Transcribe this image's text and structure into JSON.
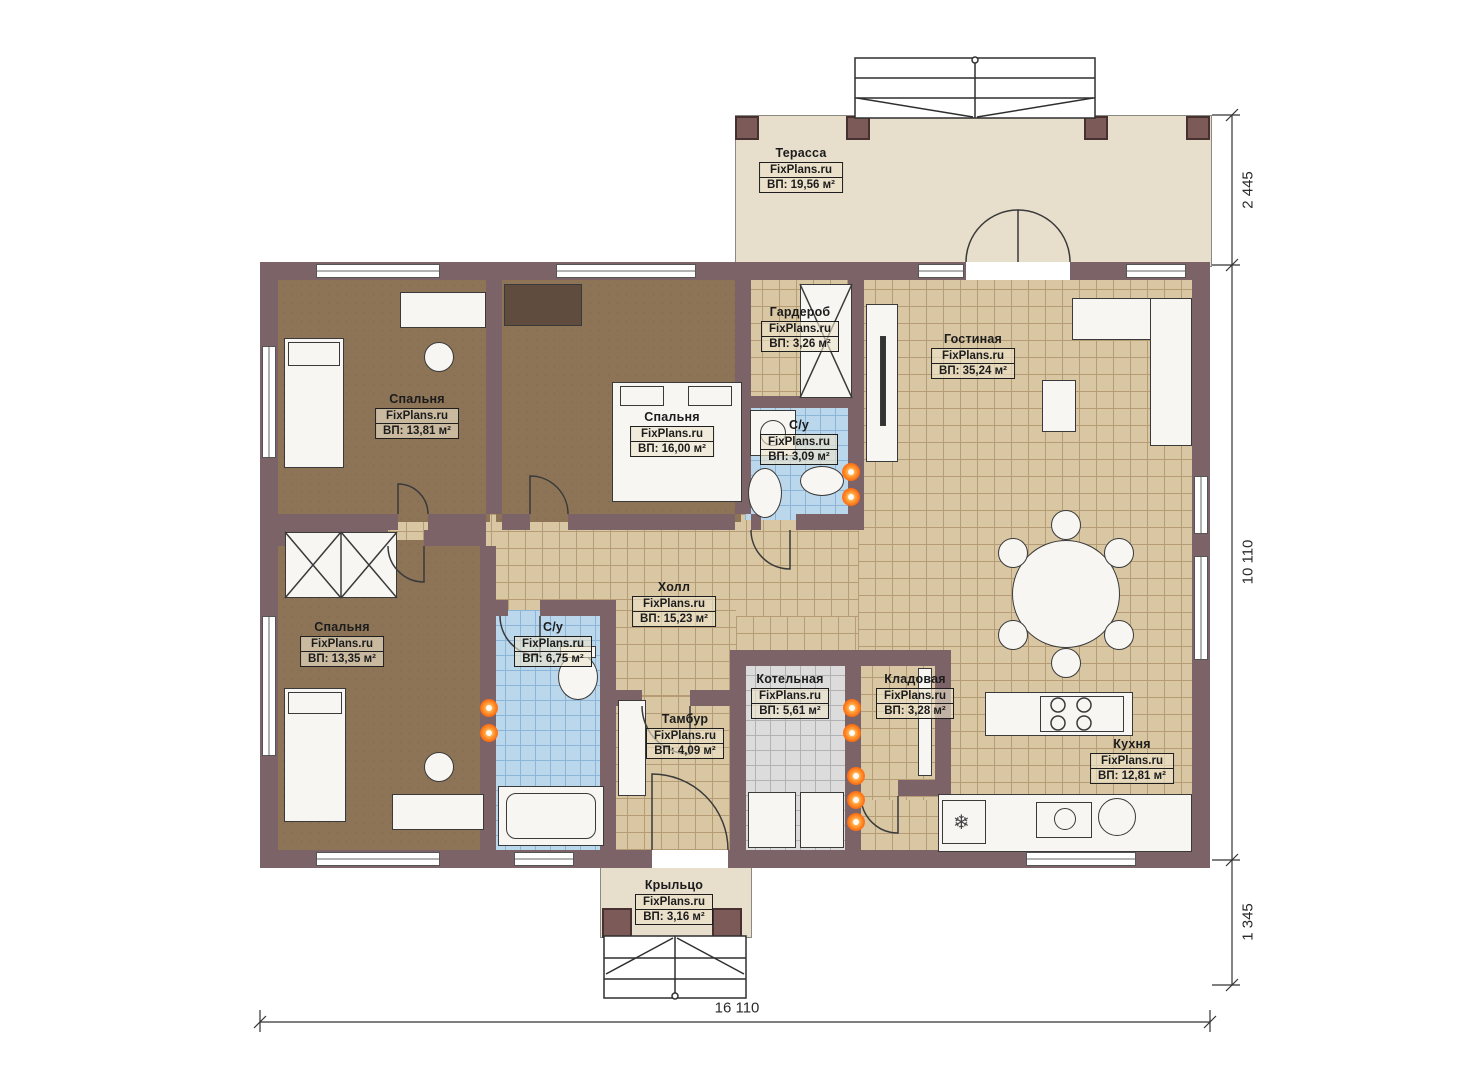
{
  "title": "План дома",
  "watermark": "FixPlans.ru",
  "rooms": [
    {
      "name": "Терасса",
      "area": "ВП: 19,56 м²"
    },
    {
      "name": "Гардероб",
      "area": "ВП: 3,26 м²"
    },
    {
      "name": "Гостиная",
      "area": "ВП: 35,24 м²"
    },
    {
      "name": "Спальня",
      "area": "ВП: 13,81 м²"
    },
    {
      "name": "Спальня",
      "area": "ВП: 16,00 м²"
    },
    {
      "name": "С/у",
      "area": "ВП: 3,09 м²"
    },
    {
      "name": "Холл",
      "area": "ВП: 15,23 м²"
    },
    {
      "name": "Спальня",
      "area": "ВП: 13,35 м²"
    },
    {
      "name": "С/у",
      "area": "ВП: 6,75 м²"
    },
    {
      "name": "Тамбур",
      "area": "ВП: 4,09 м²"
    },
    {
      "name": "Котельная",
      "area": "ВП: 5,61 м²"
    },
    {
      "name": "Кладовая",
      "area": "ВП: 3,28 м²"
    },
    {
      "name": "Кухня",
      "area": "ВП: 12,81 м²"
    },
    {
      "name": "Крыльцо",
      "area": "ВП: 3,16 м²"
    }
  ],
  "dimensions": {
    "right_top": "2 445",
    "right_middle": "10 110",
    "right_bottom": "1 345",
    "bottom": "16 110"
  },
  "icons": {
    "snowflake": "❄"
  },
  "colors": {
    "wall": "#7b6367",
    "floor_wood": "#8d7457",
    "tile_tan": "#d9c7a3",
    "tile_blue": "#bad7ec",
    "tile_gray": "#dcdcdc",
    "terrace": "#e7decb",
    "heat_marker": "#ff6f12"
  }
}
